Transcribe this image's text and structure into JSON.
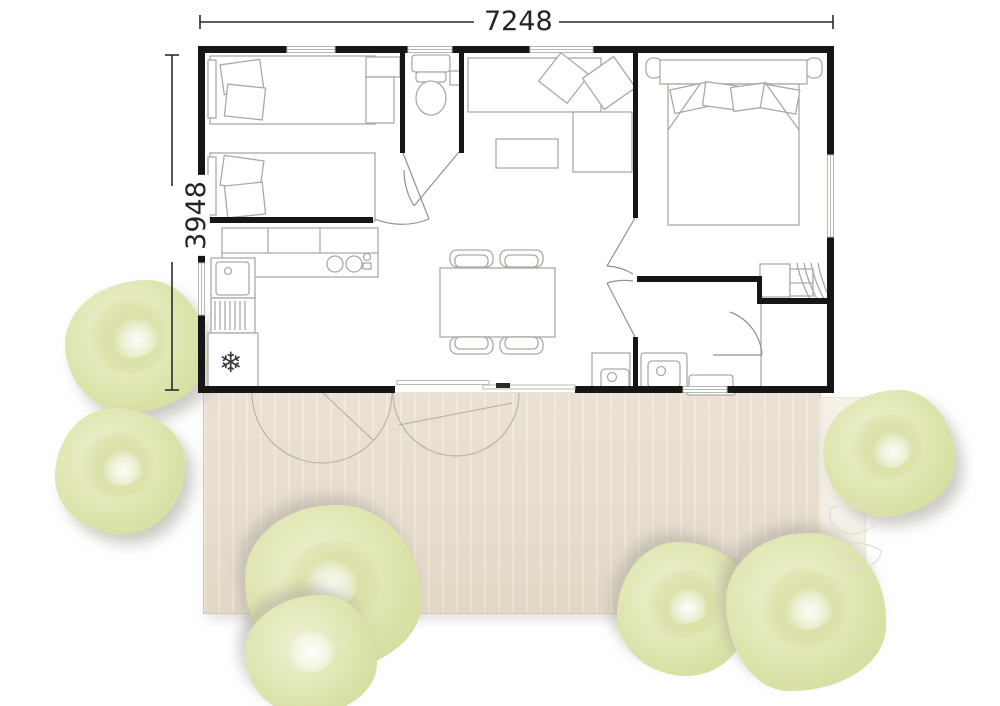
{
  "dimensions": {
    "width_label": "7248",
    "height_label": "3948"
  },
  "icons": {
    "snowflake": "❄"
  },
  "colors": {
    "wall": "#161616",
    "furniture_line": "#a7aca3",
    "door_line": "#8f948c",
    "window_frame": "#b6bbb1",
    "dimension_line": "#2b2b2b",
    "terrace": "#e8dfd1",
    "tree_fill": "#dfe5af",
    "background": "#ffffff"
  }
}
